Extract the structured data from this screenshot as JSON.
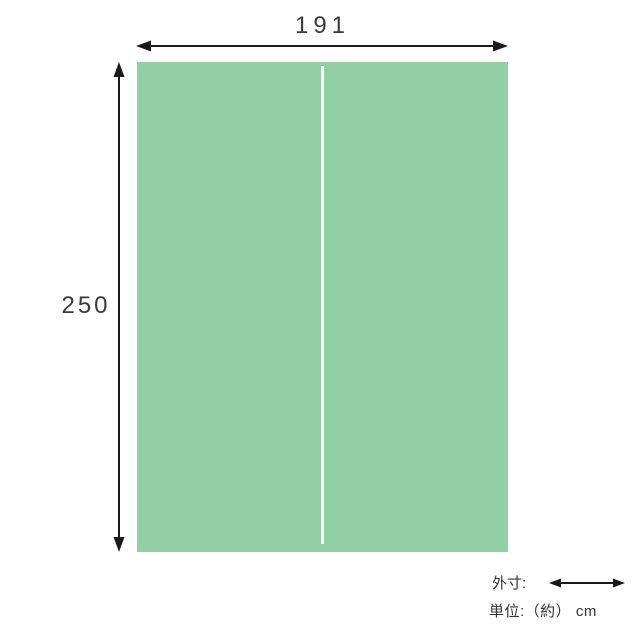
{
  "diagram": {
    "type": "product-dimension-diagram",
    "width_value": "191",
    "height_value": "250",
    "panel": {
      "name": "futon-cover-front-view",
      "has_center_seam": true
    }
  },
  "legend": {
    "outer_label": "外寸:",
    "unit_label": "単位:（約） cm"
  },
  "colors": {
    "panel_green": "#93CFA4",
    "seam_white": "#FFFFFF",
    "arrow_black": "#1A1A1A",
    "text_dark": "#3A3A3A"
  }
}
